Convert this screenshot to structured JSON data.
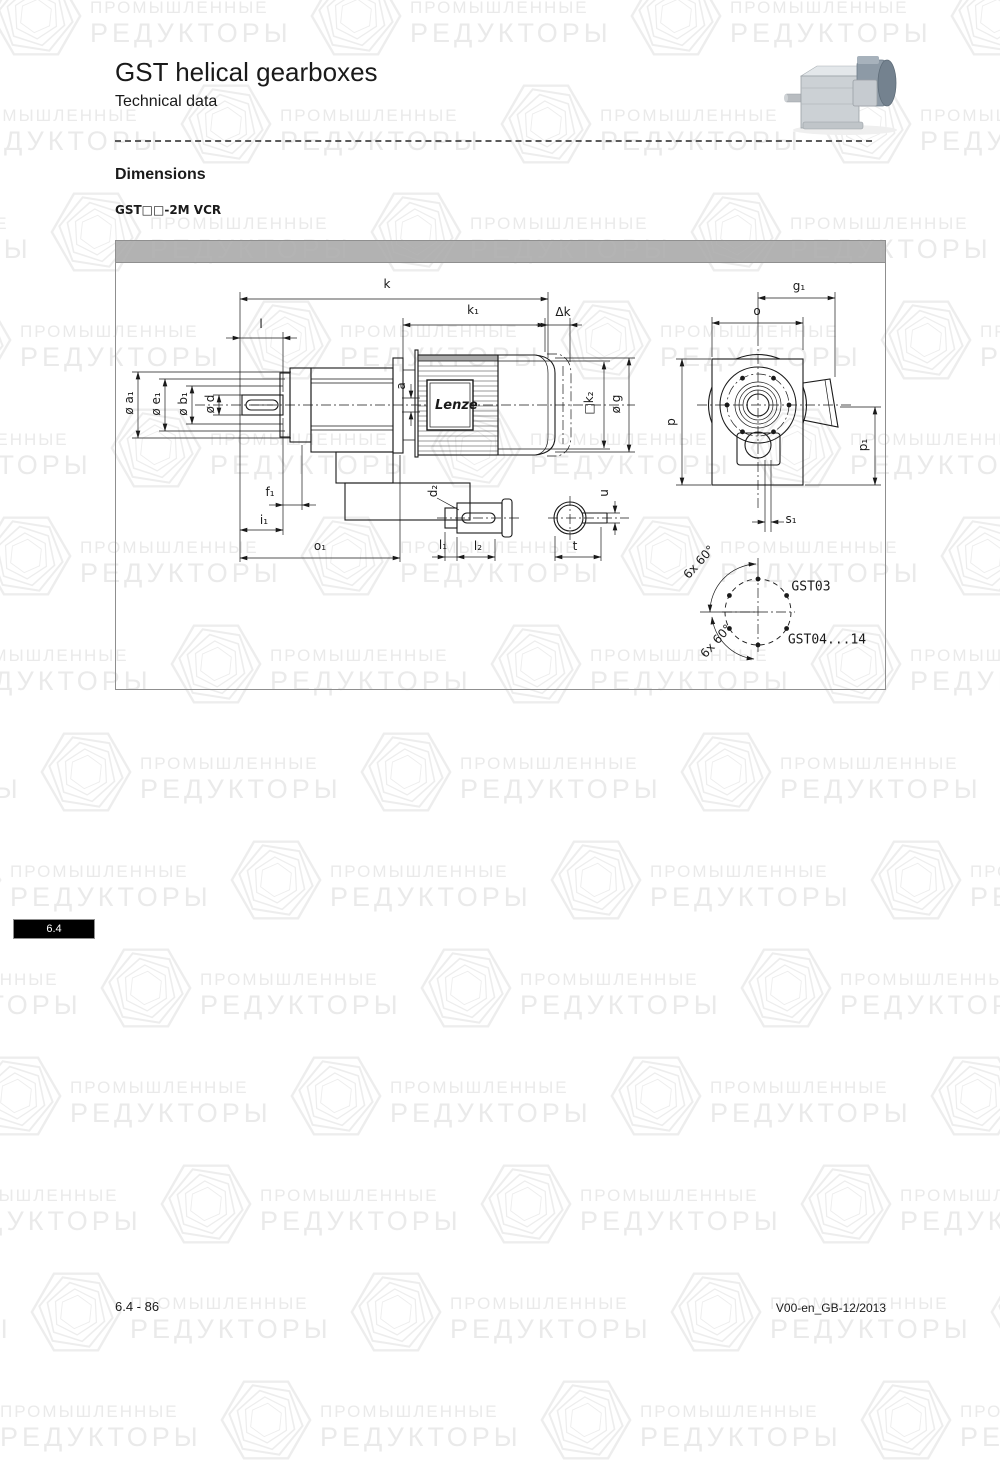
{
  "page": {
    "title": "GST helical gearboxes",
    "subtitle": "Technical data",
    "section_heading": "Dimensions",
    "model_label": "GST□□-2M VCR",
    "tab_label": "6.4",
    "footer_left": "6.4 - 86",
    "footer_right": "V00-en_GB-12/2013"
  },
  "watermark": {
    "line1": "ПРОМЫШЛЕННЫЕ",
    "line2": "РЕДУКТОРЫ"
  },
  "drawing": {
    "brand_label": "Lenze",
    "labels": [
      {
        "id": "k",
        "text": "k",
        "x": 272,
        "y": 44,
        "r": 0
      },
      {
        "id": "k1",
        "text": "k₁",
        "x": 358,
        "y": 70,
        "r": 0
      },
      {
        "id": "delta-k",
        "text": "Δk",
        "x": 448,
        "y": 72,
        "r": 0
      },
      {
        "id": "l",
        "text": "l",
        "x": 146,
        "y": 84,
        "r": 0
      },
      {
        "id": "dia-a1",
        "text": "ø a₁",
        "x": 14,
        "y": 163,
        "r": -90
      },
      {
        "id": "dia-e1",
        "text": "ø e₁",
        "x": 41,
        "y": 164,
        "r": -90
      },
      {
        "id": "dia-b1",
        "text": "ø b₁",
        "x": 68,
        "y": 164,
        "r": -90
      },
      {
        "id": "dia-d",
        "text": "ø d",
        "x": 95,
        "y": 164,
        "r": -90
      },
      {
        "id": "a",
        "text": "a",
        "x": 286,
        "y": 146,
        "r": -90
      },
      {
        "id": "k2",
        "text": "□k₂",
        "x": 474,
        "y": 163,
        "r": -90
      },
      {
        "id": "dia-g",
        "text": "ø g",
        "x": 501,
        "y": 164,
        "r": -90
      },
      {
        "id": "f1",
        "text": "f₁",
        "x": 155,
        "y": 252,
        "r": 0
      },
      {
        "id": "i1",
        "text": "i₁",
        "x": 149,
        "y": 280,
        "r": 0
      },
      {
        "id": "o1",
        "text": "o₁",
        "x": 205,
        "y": 306,
        "r": 0
      },
      {
        "id": "d2",
        "text": "d₂",
        "x": 318,
        "y": 251,
        "r": -90
      },
      {
        "id": "l1",
        "text": "l₁",
        "x": 328,
        "y": 305,
        "r": 0
      },
      {
        "id": "l2",
        "text": "l₂",
        "x": 363,
        "y": 306,
        "r": 0
      },
      {
        "id": "t",
        "text": "t",
        "x": 460,
        "y": 306,
        "r": 0
      },
      {
        "id": "u",
        "text": "u",
        "x": 489,
        "y": 253,
        "r": -90
      },
      {
        "id": "g1",
        "text": "g₁",
        "x": 684,
        "y": 46,
        "r": 0
      },
      {
        "id": "o",
        "text": "o",
        "x": 642,
        "y": 71,
        "r": 0
      },
      {
        "id": "p",
        "text": "p",
        "x": 556,
        "y": 182,
        "r": -90
      },
      {
        "id": "p1",
        "text": "p₁",
        "x": 748,
        "y": 205,
        "r": -90
      },
      {
        "id": "s1",
        "text": "s₁",
        "x": 676,
        "y": 279,
        "r": 0
      },
      {
        "id": "bolt-angle-top",
        "text": "6x 60°",
        "x": 584,
        "y": 322,
        "r": -48
      },
      {
        "id": "gst03",
        "text": "GST03",
        "x": 696,
        "y": 347,
        "r": 0,
        "cls": "tech"
      },
      {
        "id": "bolt-angle-bottom",
        "text": "6x 60°",
        "x": 601,
        "y": 401,
        "r": -48
      },
      {
        "id": "gst04-14",
        "text": "GST04...14",
        "x": 712,
        "y": 400,
        "r": 0,
        "cls": "tech"
      }
    ]
  }
}
